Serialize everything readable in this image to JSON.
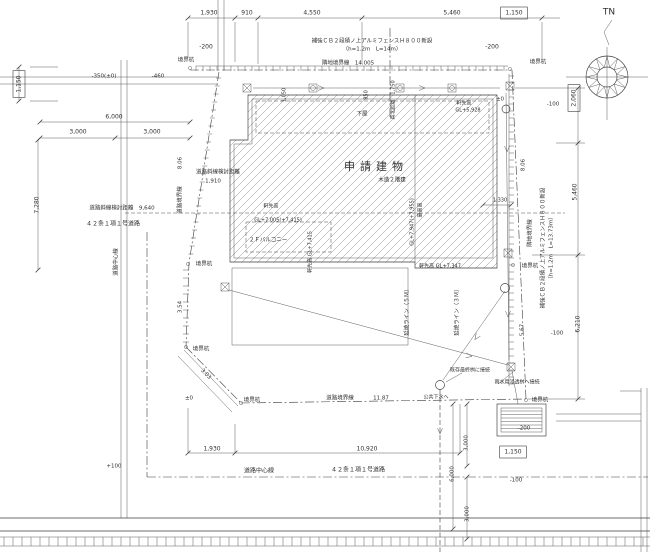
{
  "drawing": {
    "type": "architectural-site-plan",
    "title_block": "申請建物 配置図",
    "building_label": "申請建物",
    "building_structure": "木造２階建",
    "north_mark": "TN",
    "colors": {
      "line": "#3b3b3b",
      "text": "#2f2f2f",
      "background": "#ffffff"
    }
  },
  "labels": [
    {
      "id": "north-tn",
      "t": "TN",
      "x": 609,
      "y": 12,
      "s": 9
    },
    {
      "id": "dim-top-1930",
      "t": "1,930",
      "x": 209,
      "y": 13
    },
    {
      "id": "dim-top-910",
      "t": "910",
      "x": 247,
      "y": 13
    },
    {
      "id": "dim-top-4550",
      "t": "4,550",
      "x": 312,
      "y": 13
    },
    {
      "id": "dim-top-5460",
      "t": "5,460",
      "x": 452,
      "y": 13
    },
    {
      "id": "dim-top-1150",
      "t": "1,150",
      "x": 514,
      "y": 13,
      "boxed": 1
    },
    {
      "id": "lvl-top-left-200",
      "t": "-200",
      "x": 206,
      "y": 47
    },
    {
      "id": "note-fence-top-1",
      "t": "補強ＣＢ２段積ノ上アルミフェンスＨ８００新設",
      "x": 372,
      "y": 41,
      "s": 5.5
    },
    {
      "id": "note-fence-top-2",
      "t": "（h=1.2m　L=14m）",
      "x": 372,
      "y": 49,
      "s": 5.5
    },
    {
      "id": "lvl-top-right-200",
      "t": "-200",
      "x": 492,
      "y": 47
    },
    {
      "id": "stake-top-left",
      "t": "境界杭",
      "x": 186,
      "y": 60,
      "s": 5.5
    },
    {
      "id": "line-adjacent-top",
      "t": "隣地境界線　14.005",
      "x": 348,
      "y": 63,
      "s": 5.5
    },
    {
      "id": "stake-top-right",
      "t": "境界杭",
      "x": 538,
      "y": 62,
      "s": 5.5
    },
    {
      "id": "lvl-left-350",
      "t": "-350(±0)",
      "x": 104,
      "y": 76,
      "s": 5.5
    },
    {
      "id": "lvl-left-460",
      "t": "-460",
      "x": 158,
      "y": 76,
      "s": 5.5
    },
    {
      "id": "dim-left-1150",
      "t": "1,150",
      "x": 19,
      "y": 84,
      "r": -90,
      "boxed": 1
    },
    {
      "id": "dim-left-6000",
      "t": "6,000",
      "x": 114,
      "y": 117
    },
    {
      "id": "dim-left-3000a",
      "t": "3,000",
      "x": 78,
      "y": 132
    },
    {
      "id": "dim-left-3000b",
      "t": "3,000",
      "x": 152,
      "y": 132
    },
    {
      "id": "dim-left-7280",
      "t": "7,280",
      "x": 37,
      "y": 205,
      "r": -90
    },
    {
      "id": "note-road-setback-9640",
      "t": "道路斜線検討距離　9,640",
      "x": 122,
      "y": 208,
      "s": 5.5
    },
    {
      "id": "note-road-article-left",
      "t": "４２条１項１号道路",
      "x": 113,
      "y": 224
    },
    {
      "id": "note-road-center-left",
      "t": "道路中心線",
      "x": 116,
      "y": 262,
      "r": -90,
      "s": 5.5
    },
    {
      "id": "dim-west-806",
      "t": "8.06",
      "x": 180,
      "y": 163,
      "r": -90,
      "s": 5.5
    },
    {
      "id": "line-road-west",
      "t": "道路境界線",
      "x": 180,
      "y": 200,
      "r": -90,
      "s": 5.5
    },
    {
      "id": "note-setback-1910a",
      "t": "道路斜線検討距離",
      "x": 218,
      "y": 172,
      "s": 5.5
    },
    {
      "id": "note-setback-1910b",
      "t": "1,910",
      "x": 213,
      "y": 181,
      "s": 5.5
    },
    {
      "id": "stake-west-mid",
      "t": "境界杭",
      "x": 204,
      "y": 264,
      "s": 5.5
    },
    {
      "id": "dim-west-354",
      "t": "3.54",
      "x": 180,
      "y": 307,
      "r": -90,
      "s": 5.5
    },
    {
      "id": "stake-west-low",
      "t": "境界杭",
      "x": 201,
      "y": 349,
      "s": 5.5
    },
    {
      "id": "dim-corner-303",
      "t": "3.03",
      "x": 206,
      "y": 374,
      "r": 46,
      "s": 5.5
    },
    {
      "id": "lvl-corner-pm0",
      "t": "±0",
      "x": 189,
      "y": 398,
      "s": 5.5
    },
    {
      "id": "stake-bottom-left",
      "t": "境界杭",
      "x": 252,
      "y": 400,
      "s": 5.5
    },
    {
      "id": "note-geya",
      "t": "下屋",
      "x": 362,
      "y": 114,
      "s": 5.5
    },
    {
      "id": "note-eave-5928a",
      "t": "軒先高",
      "x": 464,
      "y": 103,
      "s": 5
    },
    {
      "id": "note-eave-5928b",
      "t": "GL+5,928",
      "x": 468,
      "y": 110,
      "s": 5
    },
    {
      "id": "dim-north-1750",
      "t": "真北距離　1,750",
      "x": 393,
      "y": 100,
      "r": -90,
      "s": 5
    },
    {
      "id": "dim-small-1050",
      "t": "1,050",
      "x": 284,
      "y": 95,
      "r": -90,
      "s": 5
    },
    {
      "id": "dim-small-850",
      "t": "850",
      "x": 366,
      "y": 95,
      "r": -90,
      "s": 5
    },
    {
      "id": "bldg-title",
      "t": "申請建物",
      "x": 376,
      "y": 167,
      "s": 11,
      "sp": 5
    },
    {
      "id": "bldg-structure",
      "t": "木造２階建",
      "x": 392,
      "y": 180,
      "s": 5.5
    },
    {
      "id": "note-eave-7005a",
      "t": "軒先高",
      "x": 271,
      "y": 206,
      "s": 5
    },
    {
      "id": "note-eave-7005b",
      "t": "GL+7,005(+7,415)",
      "x": 278,
      "y": 220,
      "s": 5
    },
    {
      "id": "note-balcony",
      "t": "２Ｆバルコニー",
      "x": 268,
      "y": 240,
      "s": 5.5
    },
    {
      "id": "note-eave-7415-v",
      "t": "軒先高 GL+7,415",
      "x": 310,
      "y": 252,
      "r": -90,
      "s": 5
    },
    {
      "id": "note-max-height-v1",
      "t": "最高高",
      "x": 420,
      "y": 210,
      "r": -90,
      "s": 5
    },
    {
      "id": "note-max-height-v2",
      "t": "GL+7,947(+7,955)",
      "x": 412,
      "y": 222,
      "r": -90,
      "s": 5
    },
    {
      "id": "note-eave-7347",
      "t": "軒先高 GL+7,347",
      "x": 440,
      "y": 266,
      "s": 5
    },
    {
      "id": "dim-1330",
      "t": "1,330",
      "x": 500,
      "y": 200,
      "s": 5
    },
    {
      "id": "lvl-ne-pm0",
      "t": "±0",
      "x": 500,
      "y": 99,
      "s": 5.5
    },
    {
      "id": "lvl-right-100a",
      "t": "-100",
      "x": 553,
      "y": 104,
      "s": 5.5
    },
    {
      "id": "dim-right-2060",
      "t": "2,060",
      "x": 574,
      "y": 98,
      "r": -90,
      "boxed": 1
    },
    {
      "id": "dim-right-5460",
      "t": "5,460",
      "x": 575,
      "y": 192,
      "r": -90
    },
    {
      "id": "dim-east-806",
      "t": "8.06",
      "x": 523,
      "y": 165,
      "r": -90,
      "s": 5.5
    },
    {
      "id": "line-adjacent-east",
      "t": "隣地境界線",
      "x": 530,
      "y": 233,
      "r": -90,
      "s": 5.5
    },
    {
      "id": "note-fence-east-1",
      "t": "補強ＣＢ２段積ノ上アルミフェンスＨ８００新設",
      "x": 543,
      "y": 248,
      "r": -90,
      "s": 5.5
    },
    {
      "id": "note-fence-east-2",
      "t": "（h=1.2m　L=13.73m）",
      "x": 551,
      "y": 248,
      "r": -90,
      "s": 5.5
    },
    {
      "id": "stake-east-mid",
      "t": "境界杭",
      "x": 530,
      "y": 266,
      "s": 5.5
    },
    {
      "id": "dim-east-567",
      "t": "5.67",
      "x": 522,
      "y": 330,
      "r": -90,
      "s": 5.5
    },
    {
      "id": "lvl-right-100b",
      "t": "-100",
      "x": 557,
      "y": 333,
      "s": 5.5
    },
    {
      "id": "dim-right-6210",
      "t": "6,210",
      "x": 578,
      "y": 324,
      "r": -90
    },
    {
      "id": "stake-bottom-right",
      "t": "境界杭",
      "x": 540,
      "y": 400,
      "s": 5.5
    },
    {
      "id": "note-fire-5m",
      "t": "延焼ライン（５Ｍ）",
      "x": 407,
      "y": 311,
      "r": -90,
      "s": 5.5
    },
    {
      "id": "note-fire-3m",
      "t": "延焼ライン（３Ｍ）",
      "x": 457,
      "y": 311,
      "r": -90,
      "s": 5.5
    },
    {
      "id": "line-road-bottom",
      "t": "道路境界線",
      "x": 340,
      "y": 398,
      "s": 5.5
    },
    {
      "id": "dim-bottom-1187",
      "t": "11.87",
      "x": 381,
      "y": 398,
      "s": 5.5
    },
    {
      "id": "note-sewer",
      "t": "公共下水へ",
      "x": 436,
      "y": 397,
      "s": 5
    },
    {
      "id": "note-final-masu",
      "t": "既存最終桝に接続",
      "x": 470,
      "y": 370,
      "s": 5
    },
    {
      "id": "note-rain-masu",
      "t": "雨水用浸透桝へ接続",
      "x": 517,
      "y": 382,
      "s": 5
    },
    {
      "id": "lvl-bottom-200",
      "t": "-200",
      "x": 524,
      "y": 428,
      "s": 5.5
    },
    {
      "id": "dim-bottom-3000a",
      "t": "3,000",
      "x": 466,
      "y": 443,
      "r": -90,
      "s": 5.5
    },
    {
      "id": "dim-bottom-1930",
      "t": "1,930",
      "x": 212,
      "y": 449
    },
    {
      "id": "dim-bottom-10920",
      "t": "10,920",
      "x": 367,
      "y": 449
    },
    {
      "id": "dim-bottom-1150",
      "t": "1,150",
      "x": 513,
      "y": 452,
      "boxed": 1
    },
    {
      "id": "note-road-center-bottom",
      "t": "道路中心線",
      "x": 259,
      "y": 471
    },
    {
      "id": "note-road-article-bottom",
      "t": "４２条１項１号道路",
      "x": 358,
      "y": 470
    },
    {
      "id": "lvl-bottom-plus100",
      "t": "+100",
      "x": 114,
      "y": 466,
      "s": 5.5
    },
    {
      "id": "lvl-bottom-minus100",
      "t": "-100",
      "x": 516,
      "y": 480,
      "s": 5.5
    },
    {
      "id": "dim-bottom-6000",
      "t": "6,000",
      "x": 452,
      "y": 474,
      "r": -90,
      "s": 5.5
    },
    {
      "id": "dim-bottom-3000b",
      "t": "3,000",
      "x": 467,
      "y": 514,
      "r": -90,
      "s": 5.5
    }
  ]
}
